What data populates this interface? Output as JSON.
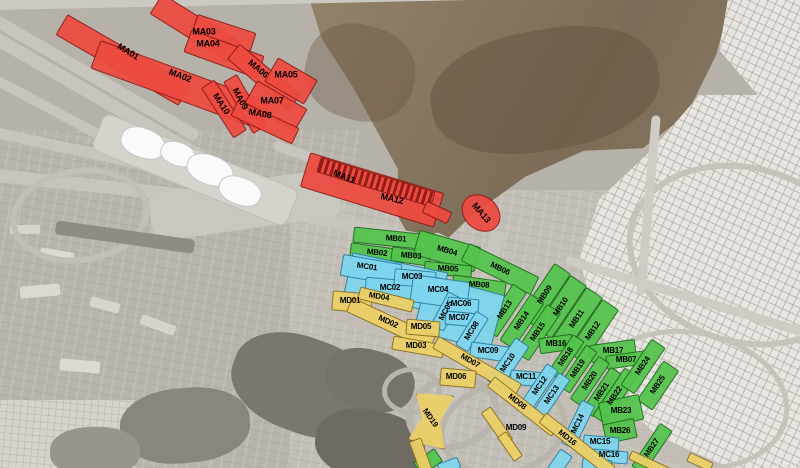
{
  "map": {
    "name": "mina-camp-zones-satellite-map",
    "region_groups": [
      {
        "id": "MA",
        "fill": "#ee4a40",
        "border": "#8c1a14",
        "label_size": 9
      },
      {
        "id": "MB",
        "fill": "#53c44c",
        "border": "#1d6b1a",
        "label_size": 8
      },
      {
        "id": "MC",
        "fill": "#7fd6ef",
        "border": "#2a7fa0",
        "label_size": 8
      },
      {
        "id": "MD",
        "fill": "#ecd066",
        "border": "#8a6f1f",
        "label_size": 8
      }
    ],
    "zones": [
      {
        "g": "MA",
        "label": "",
        "cx": 195,
        "cy": 28,
        "w": 92,
        "h": 24,
        "rot": 32
      },
      {
        "g": "MA",
        "label": "MA03",
        "cx": 224,
        "cy": 33,
        "w": 62,
        "h": 20,
        "rot": 18,
        "lx": 204,
        "ly": 32,
        "lrot": 0
      },
      {
        "g": "MA",
        "label": "MA04",
        "cx": 224,
        "cy": 54,
        "w": 78,
        "h": 24,
        "rot": 20,
        "lx": 208,
        "ly": 44,
        "lrot": 0
      },
      {
        "g": "MA",
        "label": "MA01",
        "cx": 123,
        "cy": 60,
        "w": 142,
        "h": 24,
        "rot": 30,
        "lx": 128,
        "ly": 52,
        "lrot": 31
      },
      {
        "g": "MA",
        "label": "MA02",
        "cx": 180,
        "cy": 85,
        "w": 180,
        "h": 30,
        "rot": 20,
        "lx": 180,
        "ly": 76,
        "lrot": 21
      },
      {
        "g": "MA",
        "label": "MA06",
        "cx": 264,
        "cy": 77,
        "w": 80,
        "h": 20,
        "rot": 40,
        "lx": 258,
        "ly": 69,
        "lrot": 40
      },
      {
        "g": "MA",
        "label": "MA05",
        "cx": 291,
        "cy": 81,
        "w": 46,
        "h": 28,
        "rot": 30,
        "lx": 286,
        "ly": 75,
        "lrot": 0
      },
      {
        "g": "MA",
        "label": "MA09",
        "cx": 245,
        "cy": 104,
        "w": 60,
        "h": 16,
        "rot": 60,
        "lx": 240,
        "ly": 99,
        "lrot": 62
      },
      {
        "g": "MA",
        "label": "MA10",
        "cx": 224,
        "cy": 109,
        "w": 60,
        "h": 16,
        "rot": 57,
        "lx": 221,
        "ly": 104,
        "lrot": 57
      },
      {
        "g": "MA",
        "label": "MA07",
        "cx": 276,
        "cy": 106,
        "w": 58,
        "h": 26,
        "rot": 30,
        "lx": 272,
        "ly": 101,
        "lrot": 0
      },
      {
        "g": "MA",
        "label": "MA08",
        "cx": 265,
        "cy": 122,
        "w": 68,
        "h": 18,
        "rot": 25,
        "lx": 260,
        "ly": 114,
        "lrot": 10
      },
      {
        "g": "MA",
        "label": "MA11",
        "cx": 372,
        "cy": 190,
        "w": 140,
        "h": 36,
        "rot": 17,
        "lx": 344,
        "ly": 177,
        "lrot": 22
      },
      {
        "g": "MA",
        "label": "",
        "shape": "hatch",
        "cx": 376,
        "cy": 182,
        "w": 120,
        "h": 16,
        "rot": 17
      },
      {
        "g": "MA",
        "label": "MA12",
        "shape": "label-only",
        "lx": 392,
        "ly": 199,
        "lrot": 13
      },
      {
        "g": "MA",
        "label": "",
        "cx": 437,
        "cy": 212,
        "w": 28,
        "h": 13,
        "rot": 25
      },
      {
        "g": "MA",
        "label": "MA13",
        "shape": "ellipse",
        "cx": 481,
        "cy": 213,
        "w": 42,
        "h": 34,
        "rot": 40,
        "lx": 481,
        "ly": 213,
        "lrot": 50
      },
      {
        "g": "MB",
        "label": "MB01",
        "cx": 396,
        "cy": 239,
        "w": 86,
        "h": 16,
        "rot": 6,
        "lrot": 4
      },
      {
        "g": "MB",
        "label": "MB02",
        "cx": 377,
        "cy": 253,
        "w": 54,
        "h": 14,
        "rot": 8,
        "lrot": 6
      },
      {
        "g": "MB",
        "label": "MB03",
        "cx": 411,
        "cy": 256,
        "w": 40,
        "h": 15,
        "rot": 8,
        "lrot": 5
      },
      {
        "g": "MB",
        "label": "MB04",
        "cx": 447,
        "cy": 251,
        "w": 64,
        "h": 26,
        "rot": 16,
        "lrot": 16
      },
      {
        "g": "MB",
        "label": "MB05",
        "cx": 448,
        "cy": 269,
        "w": 48,
        "h": 13,
        "rot": 6,
        "lrot": 3
      },
      {
        "g": "MB",
        "label": "MB06",
        "cx": 500,
        "cy": 269,
        "w": 78,
        "h": 20,
        "rot": 26,
        "lrot": 26
      },
      {
        "g": "MB",
        "label": "MB08",
        "cx": 479,
        "cy": 285,
        "w": 54,
        "h": 15,
        "rot": 8,
        "lrot": 4
      },
      {
        "g": "MB",
        "label": "MB09",
        "cx": 545,
        "cy": 295,
        "w": 64,
        "h": 20,
        "rot": -56,
        "lrot": -56
      },
      {
        "g": "MB",
        "label": "MB10",
        "cx": 561,
        "cy": 307,
        "w": 64,
        "h": 20,
        "rot": -56,
        "lrot": -56
      },
      {
        "g": "MB",
        "label": "MB11",
        "cx": 577,
        "cy": 319,
        "w": 64,
        "h": 20,
        "rot": -56,
        "lrot": -56
      },
      {
        "g": "MB",
        "label": "MB12",
        "cx": 593,
        "cy": 331,
        "w": 64,
        "h": 20,
        "rot": -56,
        "lrot": -56
      },
      {
        "g": "MB",
        "label": "MB13",
        "cx": 505,
        "cy": 310,
        "w": 54,
        "h": 17,
        "rot": -56,
        "lrot": -56
      },
      {
        "g": "MB",
        "label": "MB14",
        "cx": 522,
        "cy": 321,
        "w": 56,
        "h": 17,
        "rot": -56,
        "lrot": -56
      },
      {
        "g": "MB",
        "label": "MB15",
        "cx": 538,
        "cy": 332,
        "w": 58,
        "h": 17,
        "rot": -56,
        "lrot": -56
      },
      {
        "g": "MB",
        "label": "MB16",
        "cx": 556,
        "cy": 344,
        "w": 34,
        "h": 16,
        "rot": -8,
        "lrot": 0
      },
      {
        "g": "MB",
        "label": "MB17",
        "cx": 613,
        "cy": 351,
        "w": 46,
        "h": 18,
        "rot": -8,
        "lrot": 0
      },
      {
        "g": "MB",
        "label": "MB07",
        "cx": 626,
        "cy": 360,
        "w": 40,
        "h": 14,
        "rot": -8,
        "lrot": 0
      },
      {
        "g": "MB",
        "label": "MB18",
        "cx": 566,
        "cy": 357,
        "w": 46,
        "h": 14,
        "rot": -56,
        "lrot": -56
      },
      {
        "g": "MB",
        "label": "MB19",
        "cx": 578,
        "cy": 369,
        "w": 50,
        "h": 14,
        "rot": -56,
        "lrot": -56
      },
      {
        "g": "MB",
        "label": "MB20",
        "cx": 590,
        "cy": 381,
        "w": 52,
        "h": 14,
        "rot": -56,
        "lrot": -56
      },
      {
        "g": "MB",
        "label": "MB21",
        "cx": 602,
        "cy": 392,
        "w": 52,
        "h": 14,
        "rot": -56,
        "lrot": -56
      },
      {
        "g": "MB",
        "label": "MB22",
        "cx": 615,
        "cy": 396,
        "w": 58,
        "h": 16,
        "rot": -56,
        "lrot": -56
      },
      {
        "g": "MB",
        "label": "MB24",
        "cx": 643,
        "cy": 366,
        "w": 56,
        "h": 17,
        "rot": -56,
        "lrot": -56
      },
      {
        "g": "MB",
        "label": "MB25",
        "cx": 658,
        "cy": 385,
        "w": 48,
        "h": 19,
        "rot": -56,
        "lrot": -56
      },
      {
        "g": "MB",
        "label": "MB23",
        "cx": 621,
        "cy": 411,
        "w": 42,
        "h": 26,
        "rot": -12,
        "lrot": 0
      },
      {
        "g": "MB",
        "label": "MB26",
        "cx": 620,
        "cy": 431,
        "w": 32,
        "h": 20,
        "rot": -12,
        "lrot": 0
      },
      {
        "g": "MB",
        "label": "MB27",
        "cx": 652,
        "cy": 448,
        "w": 52,
        "h": 15,
        "rot": -56,
        "lrot": -56
      },
      {
        "g": "MB",
        "label": "",
        "cx": 428,
        "cy": 462,
        "w": 26,
        "h": 16,
        "rot": -35
      },
      {
        "g": "MC",
        "label": "",
        "cx": 396,
        "cy": 283,
        "w": 98,
        "h": 42,
        "rot": 12
      },
      {
        "g": "MC",
        "label": "",
        "cx": 459,
        "cy": 313,
        "w": 80,
        "h": 58,
        "rot": 15
      },
      {
        "g": "MC",
        "label": "MC01",
        "cx": 371,
        "cy": 270,
        "w": 60,
        "h": 22,
        "rot": 10,
        "lx": 367,
        "ly": 267,
        "lrot": 8
      },
      {
        "g": "MC",
        "label": "MC02",
        "cx": 392,
        "cy": 289,
        "w": 54,
        "h": 20,
        "rot": 5,
        "lx": 390,
        "ly": 288,
        "lrot": 0
      },
      {
        "g": "MC",
        "label": "MC03",
        "cx": 415,
        "cy": 278,
        "w": 42,
        "h": 17,
        "rot": 5,
        "lx": 412,
        "ly": 277,
        "lrot": 0
      },
      {
        "g": "MC",
        "label": "MC04",
        "cx": 440,
        "cy": 292,
        "w": 58,
        "h": 28,
        "rot": 8,
        "lx": 438,
        "ly": 290,
        "lrot": 0
      },
      {
        "g": "MC",
        "label": "MC05",
        "cx": 446,
        "cy": 311,
        "w": 38,
        "h": 15,
        "rot": -62,
        "lrot": -62
      },
      {
        "g": "MC",
        "label": "MC06",
        "cx": 463,
        "cy": 305,
        "w": 32,
        "h": 15,
        "rot": 5,
        "lx": 461,
        "ly": 304,
        "lrot": 0
      },
      {
        "g": "MC",
        "label": "MC07",
        "cx": 461,
        "cy": 319,
        "w": 32,
        "h": 14,
        "rot": 5,
        "lx": 459,
        "ly": 318,
        "lrot": 0
      },
      {
        "g": "MC",
        "label": "MC08",
        "cx": 472,
        "cy": 331,
        "w": 40,
        "h": 15,
        "rot": -58,
        "lrot": -58
      },
      {
        "g": "MC",
        "label": "MC09",
        "cx": 490,
        "cy": 352,
        "w": 40,
        "h": 16,
        "rot": 8,
        "lx": 488,
        "ly": 351,
        "lrot": 0
      },
      {
        "g": "MC",
        "label": "MC10",
        "cx": 508,
        "cy": 363,
        "w": 52,
        "h": 17,
        "rot": -56,
        "lrot": -56
      },
      {
        "g": "MC",
        "label": "MC11",
        "cx": 528,
        "cy": 378,
        "w": 36,
        "h": 15,
        "rot": 5,
        "lx": 526,
        "ly": 377,
        "lrot": 0
      },
      {
        "g": "MC",
        "label": "MC12",
        "cx": 540,
        "cy": 386,
        "w": 46,
        "h": 14,
        "rot": -56,
        "lrot": -56
      },
      {
        "g": "MC",
        "label": "MC13",
        "cx": 552,
        "cy": 395,
        "w": 46,
        "h": 14,
        "rot": -56,
        "lrot": -56
      },
      {
        "g": "MC",
        "label": "MC14",
        "cx": 578,
        "cy": 424,
        "w": 48,
        "h": 15,
        "rot": -64,
        "lrot": -64
      },
      {
        "g": "MC",
        "label": "MC15",
        "cx": 601,
        "cy": 443,
        "w": 36,
        "h": 15,
        "rot": 5,
        "lx": 600,
        "ly": 442,
        "lrot": 0
      },
      {
        "g": "MC",
        "label": "MC16",
        "cx": 610,
        "cy": 456,
        "w": 36,
        "h": 13,
        "rot": 5,
        "lx": 609,
        "ly": 455,
        "lrot": 0
      },
      {
        "g": "MC",
        "label": "",
        "cx": 560,
        "cy": 462,
        "w": 24,
        "h": 15,
        "rot": -56
      },
      {
        "g": "MC",
        "label": "",
        "cx": 597,
        "cy": 465,
        "w": 30,
        "h": 12,
        "rot": 5
      },
      {
        "g": "MC",
        "label": "",
        "cx": 449,
        "cy": 466,
        "w": 22,
        "h": 12,
        "rot": -20
      },
      {
        "g": "MD",
        "label": "MD01",
        "cx": 352,
        "cy": 302,
        "w": 40,
        "h": 20,
        "rot": 5,
        "lx": 350,
        "ly": 301,
        "lrot": 0
      },
      {
        "g": "MD",
        "label": "MD04",
        "cx": 386,
        "cy": 299,
        "w": 56,
        "h": 13,
        "rot": 14,
        "lx": 379,
        "ly": 297,
        "lrot": 10
      },
      {
        "g": "MD",
        "label": "MD02",
        "cx": 391,
        "cy": 324,
        "w": 92,
        "h": 16,
        "rot": 25,
        "lx": 388,
        "ly": 322,
        "lrot": 25
      },
      {
        "g": "MD",
        "label": "MD05",
        "cx": 423,
        "cy": 328,
        "w": 34,
        "h": 16,
        "rot": 5,
        "lx": 421,
        "ly": 327,
        "lrot": 0
      },
      {
        "g": "MD",
        "label": "MD03",
        "cx": 418,
        "cy": 347,
        "w": 52,
        "h": 14,
        "rot": 10,
        "lx": 416,
        "ly": 346,
        "lrot": 0
      },
      {
        "g": "MD",
        "label": "MD07",
        "cx": 477,
        "cy": 366,
        "w": 96,
        "h": 14,
        "rot": 30,
        "lx": 470,
        "ly": 361,
        "lrot": 30
      },
      {
        "g": "MD",
        "label": "MD06",
        "cx": 458,
        "cy": 378,
        "w": 36,
        "h": 18,
        "rot": 5,
        "lx": 456,
        "ly": 377,
        "lrot": 0
      },
      {
        "g": "MD",
        "label": "MD08",
        "cx": 523,
        "cy": 406,
        "w": 82,
        "h": 13,
        "rot": 38,
        "lx": 517,
        "ly": 402,
        "lrot": 38
      },
      {
        "g": "MD",
        "label": "MD09",
        "shape": "label-only",
        "lx": 516,
        "ly": 428,
        "lrot": 0
      },
      {
        "g": "MD",
        "label": "MD16",
        "cx": 577,
        "cy": 444,
        "w": 88,
        "h": 13,
        "rot": 38,
        "lx": 567,
        "ly": 438,
        "lrot": 38
      },
      {
        "g": "MD",
        "label": "MD19",
        "shape": "bowtie",
        "cx": 431,
        "cy": 419,
        "w": 38,
        "h": 55,
        "rot": 10,
        "lx": 430,
        "ly": 418,
        "lrot": 55
      },
      {
        "g": "MD",
        "label": "",
        "cx": 497,
        "cy": 426,
        "w": 40,
        "h": 12,
        "rot": 55
      },
      {
        "g": "MD",
        "label": "",
        "cx": 510,
        "cy": 446,
        "w": 30,
        "h": 11,
        "rot": 55
      },
      {
        "g": "MD",
        "label": "",
        "cx": 421,
        "cy": 456,
        "w": 36,
        "h": 13,
        "rot": 70
      },
      {
        "g": "MD",
        "label": "",
        "cx": 650,
        "cy": 464,
        "w": 44,
        "h": 10,
        "rot": 25
      },
      {
        "g": "MD",
        "label": "",
        "cx": 700,
        "cy": 462,
        "w": 26,
        "h": 10,
        "rot": 25
      }
    ]
  }
}
